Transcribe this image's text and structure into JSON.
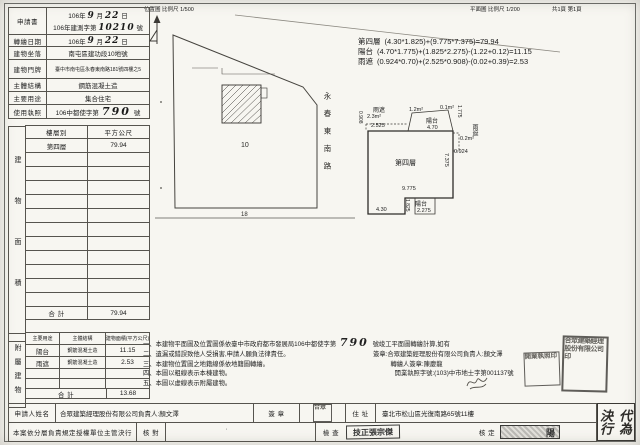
{
  "header": {
    "loc_label": "位置圖",
    "loc_scale": "比例尺 1/500",
    "plan_label": "平面圖",
    "plan_scale": "比例尺 1/200",
    "pages": "共1頁 第1頁"
  },
  "info": {
    "r1_label": "申請書",
    "r1_year": "106年",
    "r1_month": "9",
    "r1_month_unit": "月",
    "r1_day": "22",
    "r1_day_unit": "日",
    "r1_doc_prefix": "106年建測字第",
    "r1_doc_number": "10210",
    "r1_doc_suffix": "號",
    "r2_label": "轉繪日期",
    "r2_year": "106年",
    "r2_month": "9",
    "r2_month_unit": "月",
    "r2_day": "22",
    "r2_day_unit": "日",
    "r3_label": "建物坐落",
    "r3_value": "南屯區建功段10地號",
    "r4_label": "建物門牌",
    "r4_value": "臺中市南屯區永春東南路181號四樓之5",
    "r5_label": "主體結構",
    "r5_value": "鋼筋混凝土造",
    "r6_label": "主要用途",
    "r6_value": "集合住宅",
    "r7_label": "使用執照",
    "r7_prefix": "106中都使字第",
    "r7_number": "790",
    "r7_suffix": "號"
  },
  "area_table": {
    "side": "建物面積",
    "col_floor": "樓層別",
    "col_sqm": "平方公尺",
    "floor": "第四層",
    "floor_sqm": "79.94",
    "total_label": "合 計",
    "total": "79.94"
  },
  "annex_table": {
    "side": "附屬建物",
    "col_use": "主要用途",
    "col_struct": "主體結構",
    "col_area": "建物面積(平方公尺)",
    "rows": [
      {
        "use": "陽台",
        "struct": "鋼筋混凝土造",
        "area": "11.15"
      },
      {
        "use": "雨遮",
        "struct": "鋼筋混凝土造",
        "area": "2.53"
      }
    ],
    "total_label": "合 計",
    "total": "13.68"
  },
  "calculations": [
    {
      "label": "第四層",
      "formula": "(4.30*1.825)+(9.775*7.375)=79.94"
    },
    {
      "label": "陽台",
      "formula": "(4.70*1.775)+(1.825*2.275)-(1.22+0.12)=11.15"
    },
    {
      "label": "雨遮",
      "formula": "(0.924*0.70)+(2.525*0.908)-(0.02+0.39)=2.53"
    }
  ],
  "map": {
    "parcel_no": "10",
    "road_no": "18",
    "road_name": "永春東南路"
  },
  "plan": {
    "canopy_left": "雨遮",
    "canopy_left_area": "2.3m²",
    "canopy_left_w": "2.525",
    "canopy_left_h": "0.908",
    "deduct_l": "1.2m²",
    "deduct_r": "0.1m²",
    "balcony_top": "陽台",
    "balcony_top_w": "4.70",
    "balcony_top_h": "1.775",
    "canopy_right": "雨遮",
    "canopy_right_area": "0.2m²",
    "canopy_right_h": "0.924",
    "main_label": "第四層",
    "main_h": "7.375",
    "main_w": "9.775",
    "ext_w": "4.30",
    "balcony_bot": "陽台",
    "balcony_bot_w": "2.275",
    "balcony_bot_h": "1.825"
  },
  "notes": {
    "n1a": "一、本建物平面圖及位置圖係依臺中市政府都市發展局106中都使字第",
    "n1_num": "790",
    "n1b": "號竣工平面圖轉繪計算,如有",
    "n2": "二、遺漏或錯誤致他人受損害,申請人願負法律責任。",
    "n2r": "簽章:合眾建築經理股份有限公司負責人:顏文澤",
    "n3": "三、本建物位置圖之地籍線係依地籍圖轉繪。",
    "n3r": "轉繪人簽章:陳慶龍",
    "n4": "四、本圖以粗線表示本棟建物。",
    "n4r": "開業執照字號:(103)中市地士字第001137號",
    "n5": "五、本圖以虛線表示附屬建物。"
  },
  "applicant": {
    "name_label": "申請人姓名",
    "name": "合眾建築經理股份有限公司負責人:顏文澤",
    "sign_label": "簽 章",
    "addr_label": "住 址",
    "address": "臺北市松山區光復南路65號11樓"
  },
  "approval": {
    "auth": "本案依分層負責規定授權單位主管決行",
    "check1": "核 對",
    "check2": "檢 查",
    "check_stamp": "技正張宗傑",
    "approve": "核 定",
    "approve_stamp": "陽",
    "delegate": "代為決行"
  },
  "stamps": {
    "company": "合眾",
    "notes_small": "開業執照印",
    "notes_big": "合眾建築經理股份有限公司印"
  }
}
